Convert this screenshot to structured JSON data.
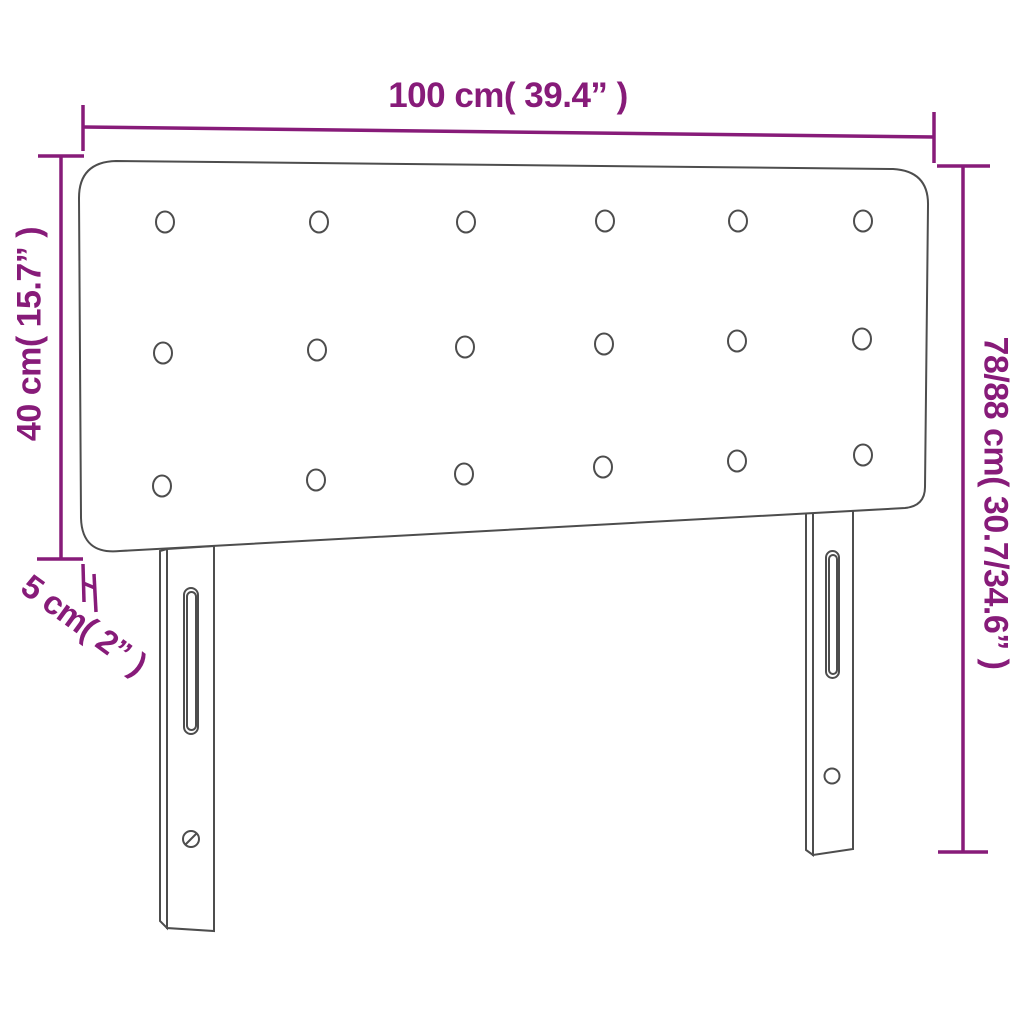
{
  "title": "Headboard dimension diagram",
  "colors": {
    "dimension": "#871B79",
    "outline": "#4D4D4D",
    "background": "#FFFFFF"
  },
  "dimensions": {
    "width": {
      "label": "100 cm( 39.4” )",
      "cm": "100",
      "inch": "39.4”"
    },
    "panel_height": {
      "label": "40 cm( 15.7” )",
      "cm": "40",
      "inch": "15.7”"
    },
    "total_height": {
      "label": "78/88 cm( 30.7/34.6” )",
      "cm": "78/88",
      "inch": "30.7/34.6”"
    },
    "panel_thickness": {
      "label": "5 cm( 2” )",
      "cm": "5",
      "inch": "2”"
    }
  },
  "figure": {
    "type": "product-dimension-diagram",
    "product": "upholstered headboard with tufted buttons and two slotted legs",
    "button_grid": {
      "rows": 3,
      "columns": 6,
      "count": 18
    }
  }
}
